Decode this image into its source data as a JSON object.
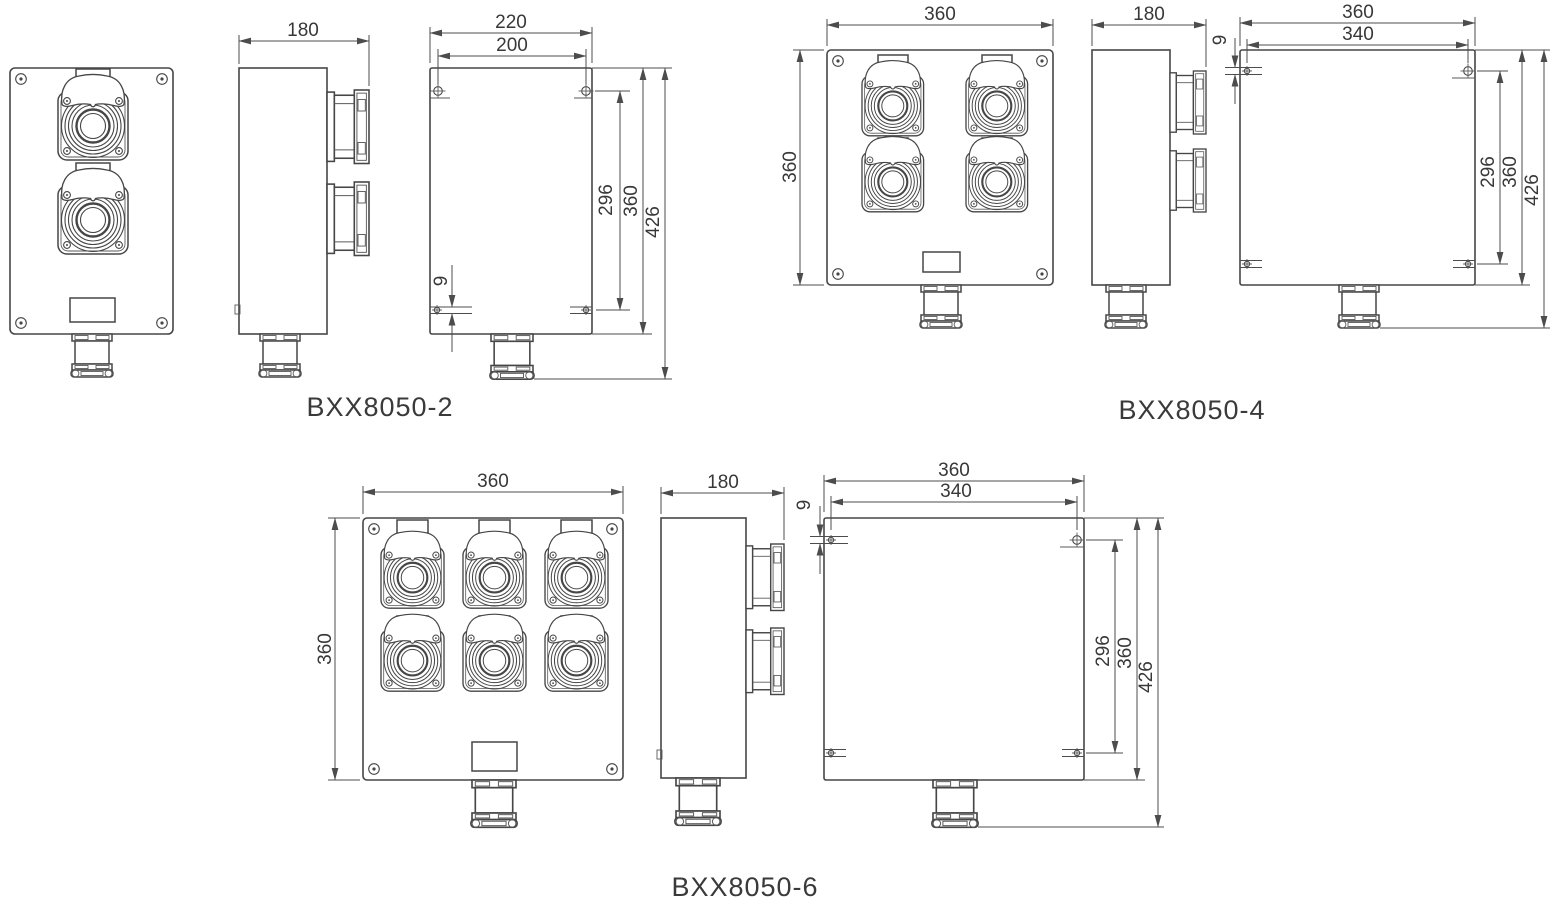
{
  "products": {
    "bxx2": {
      "caption": "BXX8050-2",
      "dims": {
        "side_width": "180",
        "back_width": "220",
        "hole_spacing_h": "200",
        "hole_spacing_v": "296",
        "body_height": "360",
        "overall_height": "426",
        "slot_offset": "9"
      }
    },
    "bxx4": {
      "caption": "BXX8050-4",
      "dims": {
        "front_width": "360",
        "front_height": "360",
        "side_width": "180",
        "back_width": "360",
        "hole_spacing_h": "340",
        "hole_spacing_v": "296",
        "body_height": "360",
        "overall_height": "426",
        "slot_offset": "9"
      }
    },
    "bxx6": {
      "caption": "BXX8050-6",
      "dims": {
        "front_width": "360",
        "front_height": "360",
        "side_width": "180",
        "back_width": "360",
        "hole_spacing_h": "340",
        "hole_spacing_v": "296",
        "body_height": "360",
        "overall_height": "426",
        "slot_offset": "9"
      }
    }
  },
  "style": {
    "line_color": "#464646",
    "text_color": "#383838",
    "background": "#ffffff"
  }
}
